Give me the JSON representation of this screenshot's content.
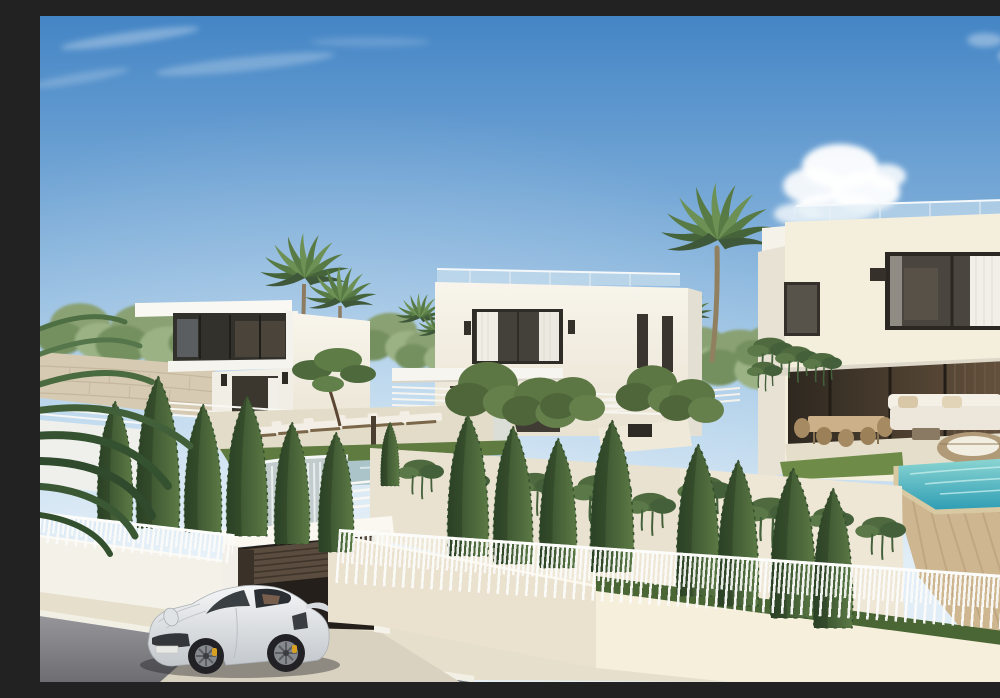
{
  "meta": {
    "type": "architectural-exterior-render",
    "description": "Sunny render of a modern white luxury villa development: three flat-roofed villas on terraced levels with cypress and palm trees, an infinity pool with waterfall, a turquoise pool, white railing fences along a sloping street, an open garage and a silver sports car pulling out",
    "width": 1000,
    "height": 666
  },
  "palette": {
    "sky_top": "#4485c5",
    "sky_mid": "#a9cce8",
    "sky_horizon": "#e2eef7",
    "cloud_white": "#ffffff",
    "villa_top": "#f8f5ec",
    "villa_bottom": "#e9e2d1",
    "villa_warm": "#f4eedd",
    "glass": "#44403a",
    "curtain": "#f2efe8",
    "sconce": "#34302a",
    "terrace_wall": "#eee7d6",
    "wall_shaded": "#eae2cf",
    "wall_sunlit": "#f6efdc",
    "stone_wall": "#d6cab2",
    "travertine": "#cdb690",
    "lawn": "#5f7b40",
    "grass_dark": "#4a6634",
    "cypress_dark": "#2f4629",
    "cypress_light": "#5c7a45",
    "palm_green": "#587a44",
    "pool_light": "#8fd8d4",
    "pool_deep": "#2f9db4",
    "infinity_pool": "#aac4ca",
    "waterfall": "#c3cccd",
    "sidewalk": "#e6dfcb",
    "road": "#85868a",
    "garage_wood": "#5a4c3e",
    "car_light": "#f5f6f7",
    "car_dark": "#c3c8cd",
    "caliper": "#d8a020",
    "wicker": "#b09a78"
  },
  "scene": {
    "objects": [
      {
        "name": "sky",
        "label": "gradient blue sky with clouds"
      },
      {
        "name": "villa-left",
        "label": "white villa with dark glass upper volume"
      },
      {
        "name": "villa-middle",
        "label": "two-storey white villa with curtained window"
      },
      {
        "name": "villa-right",
        "label": "large two-storey villa with covered terrace"
      },
      {
        "name": "infinity-pool",
        "label": "glass-edge pool with waterfall"
      },
      {
        "name": "pool-right",
        "label": "turquoise swimming pool"
      },
      {
        "name": "cypress-row",
        "label": "row of cypress trees"
      },
      {
        "name": "palm-trees",
        "label": "fan palms"
      },
      {
        "name": "street-fence",
        "label": "white baluster fence on wall"
      },
      {
        "name": "garage",
        "label": "open garage with slatted door"
      },
      {
        "name": "sports-car",
        "label": "silver 911-style sports car"
      },
      {
        "name": "road",
        "label": "asphalt street with light curb"
      }
    ]
  }
}
